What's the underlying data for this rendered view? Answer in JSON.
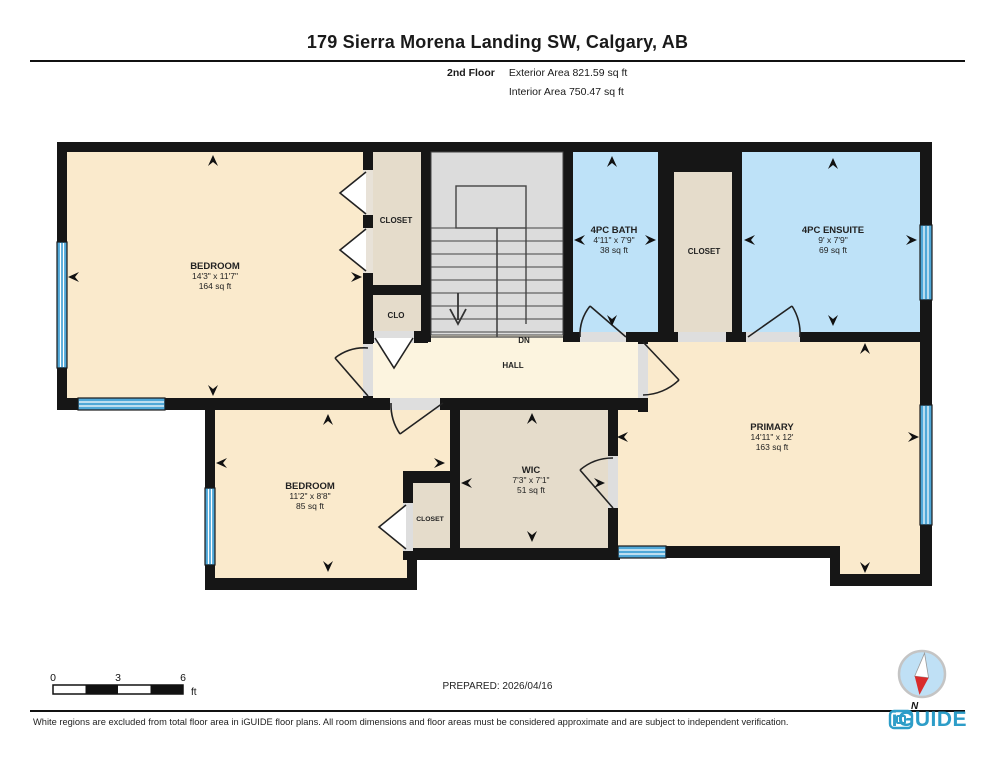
{
  "header": {
    "title": "179 Sierra Morena Landing SW, Calgary, AB",
    "floor_label": "2nd Floor",
    "exterior_area": "Exterior Area 821.59 sq ft",
    "interior_area": "Interior Area 750.47 sq ft"
  },
  "plan": {
    "rooms": [
      {
        "id": "bedroom-1",
        "name": "BEDROOM",
        "dims": "14'3\" x 11'7\"",
        "area": "164 sq ft"
      },
      {
        "id": "closet-top",
        "name": "CLOSET"
      },
      {
        "id": "clo",
        "name": "CLO"
      },
      {
        "id": "bath",
        "name": "4PC BATH",
        "dims": "4'11\" x 7'9\"",
        "area": "38 sq ft"
      },
      {
        "id": "closet-mid",
        "name": "CLOSET"
      },
      {
        "id": "ensuite",
        "name": "4PC ENSUITE",
        "dims": "9' x 7'9\"",
        "area": "69 sq ft"
      },
      {
        "id": "hall",
        "name": "HALL"
      },
      {
        "id": "stairs-dn",
        "name": "DN"
      },
      {
        "id": "primary",
        "name": "PRIMARY",
        "dims": "14'11\" x 12'",
        "area": "163 sq ft"
      },
      {
        "id": "bedroom-2",
        "name": "BEDROOM",
        "dims": "11'2\" x 8'8\"",
        "area": "85 sq ft"
      },
      {
        "id": "closet-b2",
        "name": "CLOSET"
      },
      {
        "id": "wic",
        "name": "WIC",
        "dims": "7'3\" x 7'1\"",
        "area": "51 sq ft"
      }
    ],
    "colors": {
      "wall": "#161616",
      "room_fill": "#FAEACC",
      "hall_fill": "#FCF4DF",
      "wet_room_fill": "#BEE2F8",
      "closet_fill": "#E5DCCB",
      "stairs_fill": "#DCDCDC",
      "window": "#4FA8D8",
      "brand_blue": "#2D9DC8",
      "compass_red": "#D92B2B"
    }
  },
  "footer": {
    "scale": {
      "labels": [
        "0",
        "3",
        "6"
      ],
      "unit": "ft"
    },
    "prepared": "PREPARED: 2026/04/16",
    "compass_label": "N",
    "disclaimer": "White regions are excluded from total floor area in iGUIDE floor plans. All room dimensions and floor areas must be considered approximate and are subject to independent verification.",
    "brand": "iGUIDE"
  }
}
